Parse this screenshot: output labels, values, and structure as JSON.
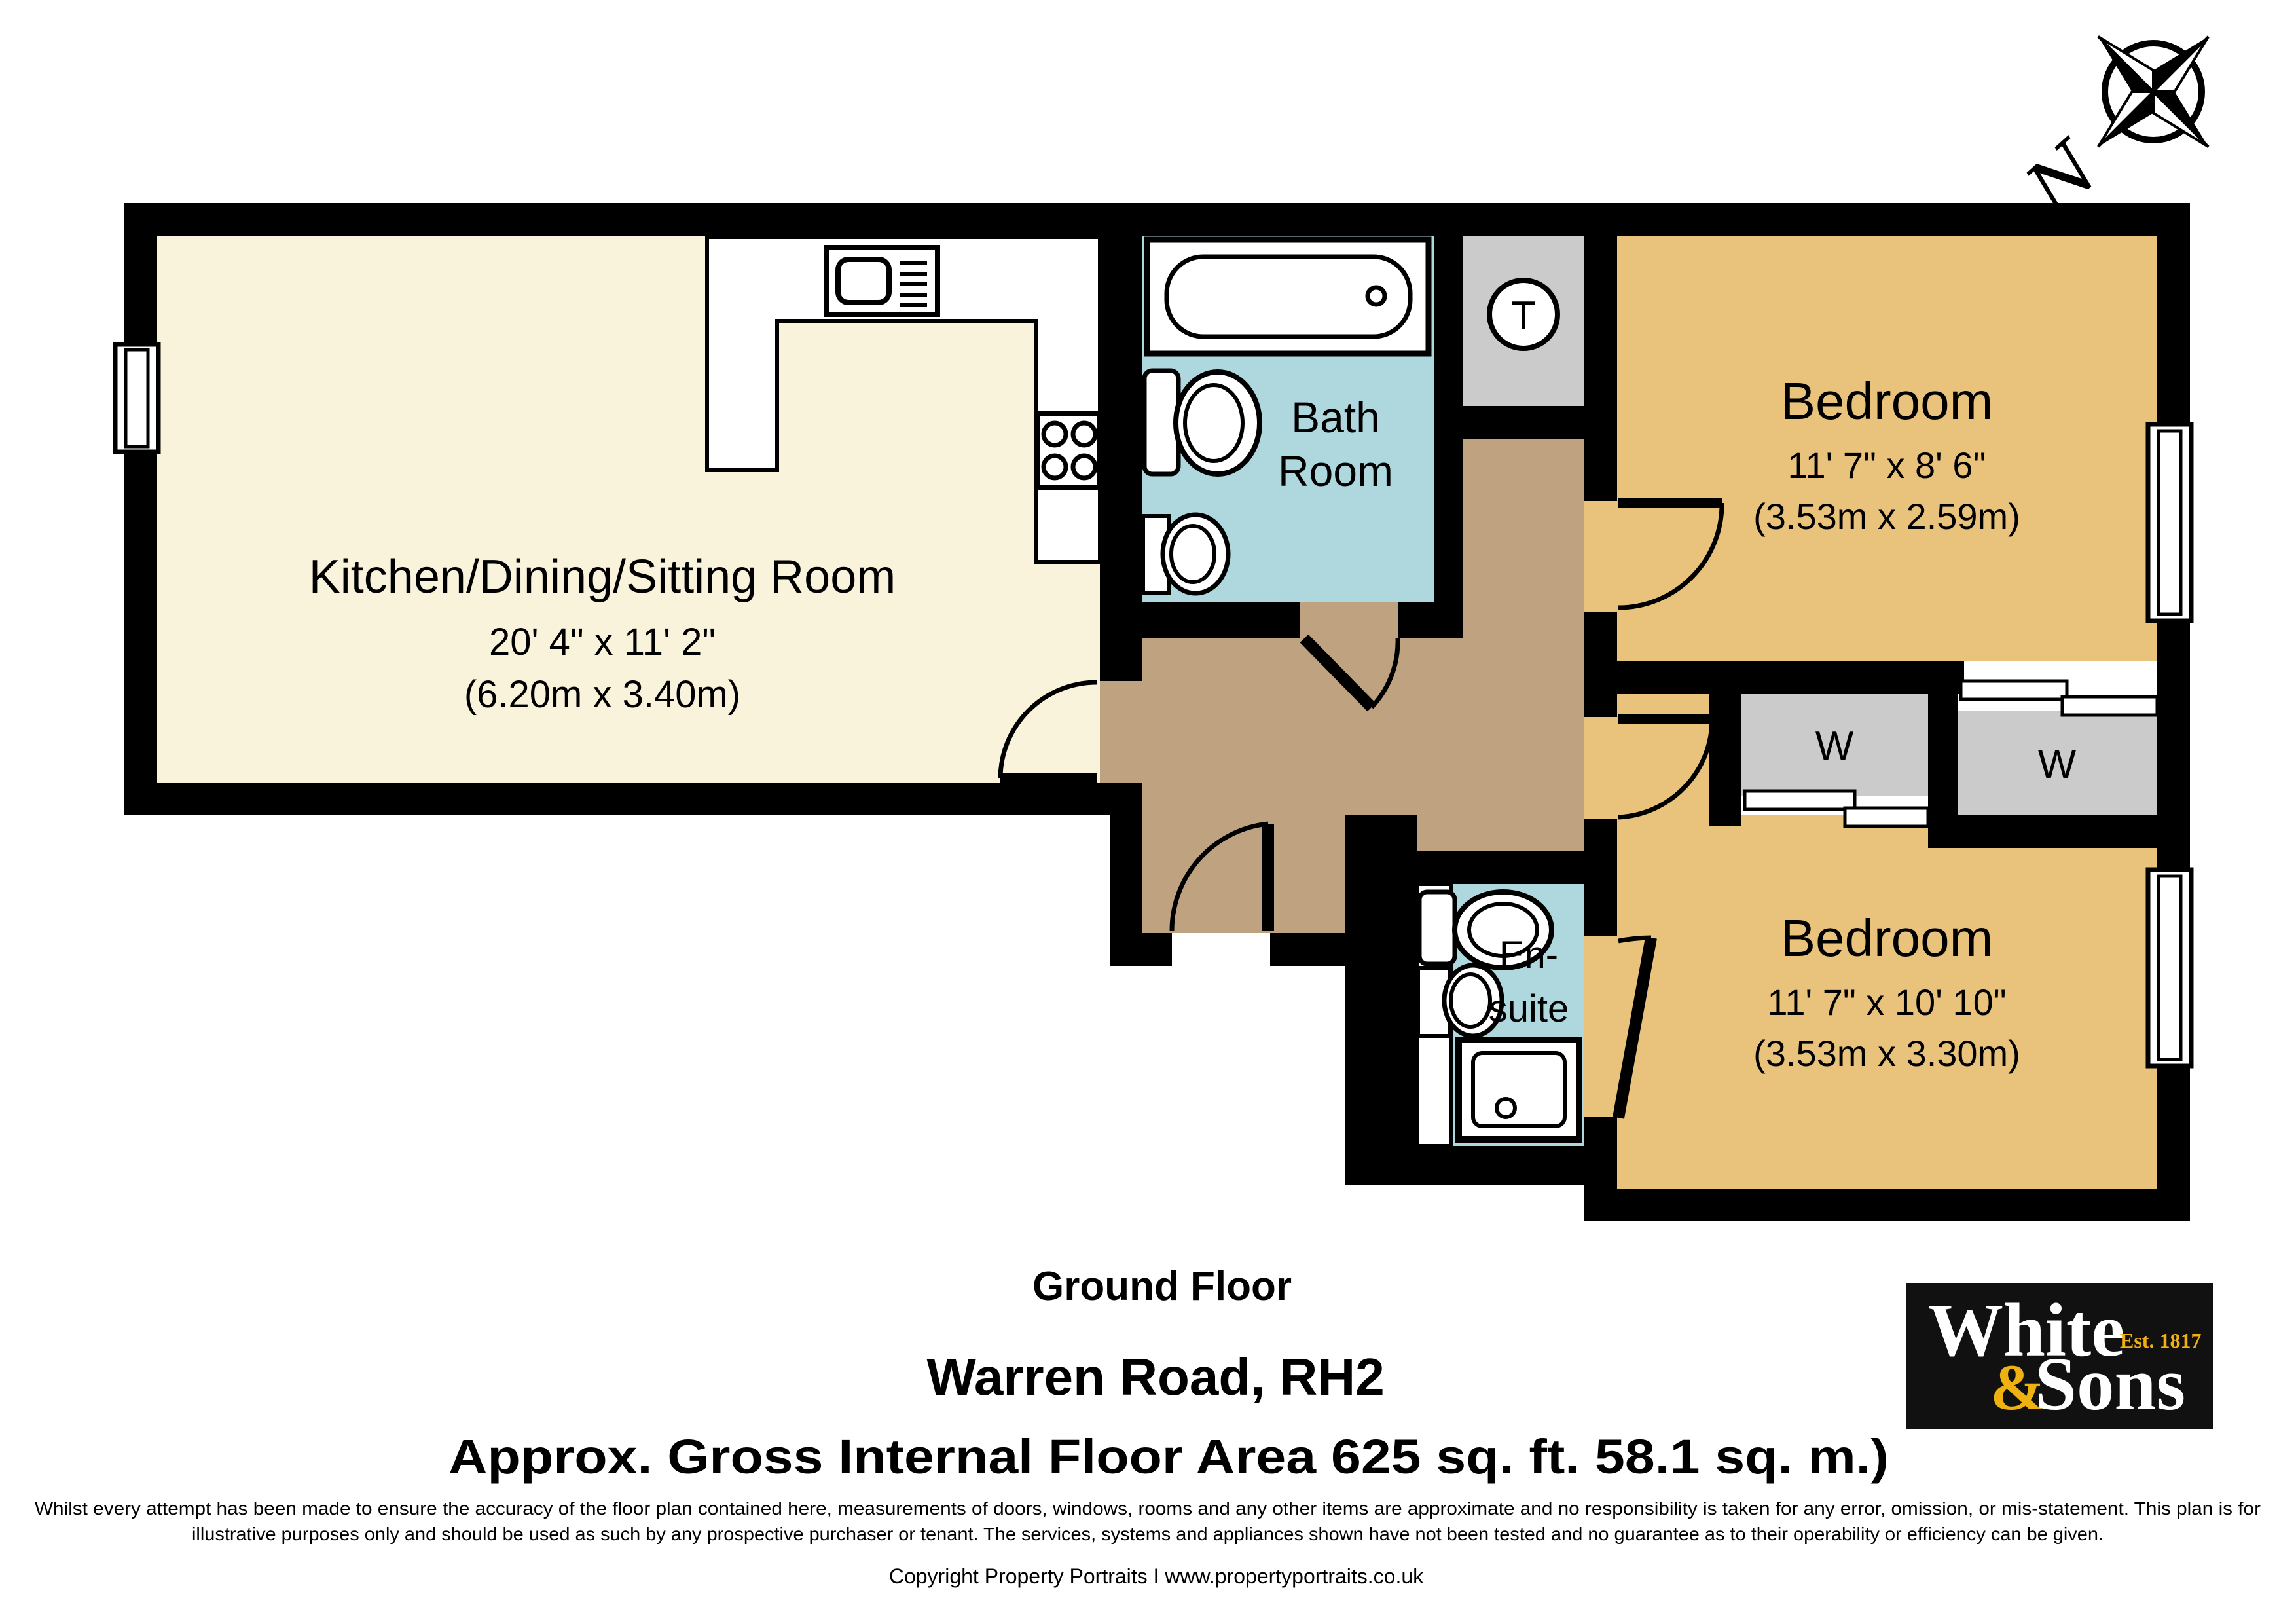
{
  "compass": {
    "label": "N"
  },
  "plan": {
    "kitchen": {
      "name": "Kitchen/Dining/Sitting Room",
      "imperial": "20' 4\" x 11' 2\"",
      "metric": "(6.20m x 3.40m)"
    },
    "bathroom": {
      "name_line1": "Bath",
      "name_line2": "Room"
    },
    "tank_cupboard": {
      "label": "T"
    },
    "bedroom_top": {
      "name": "Bedroom",
      "imperial": "11' 7\" x 8' 6\"",
      "metric": "(3.53m x 2.59m)"
    },
    "bedroom_bottom": {
      "name": "Bedroom",
      "imperial": "11' 7\" x 10' 10\"",
      "metric": "(3.53m x 3.30m)"
    },
    "ensuite": {
      "name_line1": "En-",
      "name_line2": "suite"
    },
    "wardrobes": {
      "left_label": "W",
      "right_label": "W"
    }
  },
  "footer": {
    "floor_label": "Ground Floor",
    "address": "Warren Road, RH2",
    "area_line": "Approx. Gross Internal Floor Area 625 sq. ft. 58.1 sq. m.)",
    "disclaimer_line1": "Whilst every attempt has been made to ensure the accuracy of the floor plan contained here, measurements of doors, windows, rooms and any other items are approximate and no responsibility is taken for any error, omission, or mis-statement. This plan is for",
    "disclaimer_line2": "illustrative purposes only and should be used as such by any prospective purchaser or tenant. The services, systems and appliances shown have not been tested and no guarantee as to their operability or efficiency can be given.",
    "copyright": "Copyright Property Portraits I www.propertyportraits.co.uk"
  },
  "logo": {
    "line1": "White",
    "est": "Est. 1817",
    "amp": "&",
    "line2": "Sons"
  },
  "colors": {
    "wall": "#000000",
    "kitchen_floor": "#faf3dc",
    "hall_floor": "#bfa280",
    "bedroom_floor": "#e9c27c",
    "wet_room_floor": "#aed7de",
    "cupboard": "#cbcbcb",
    "logo_background": "#111111",
    "logo_gold": "#eeb111"
  }
}
